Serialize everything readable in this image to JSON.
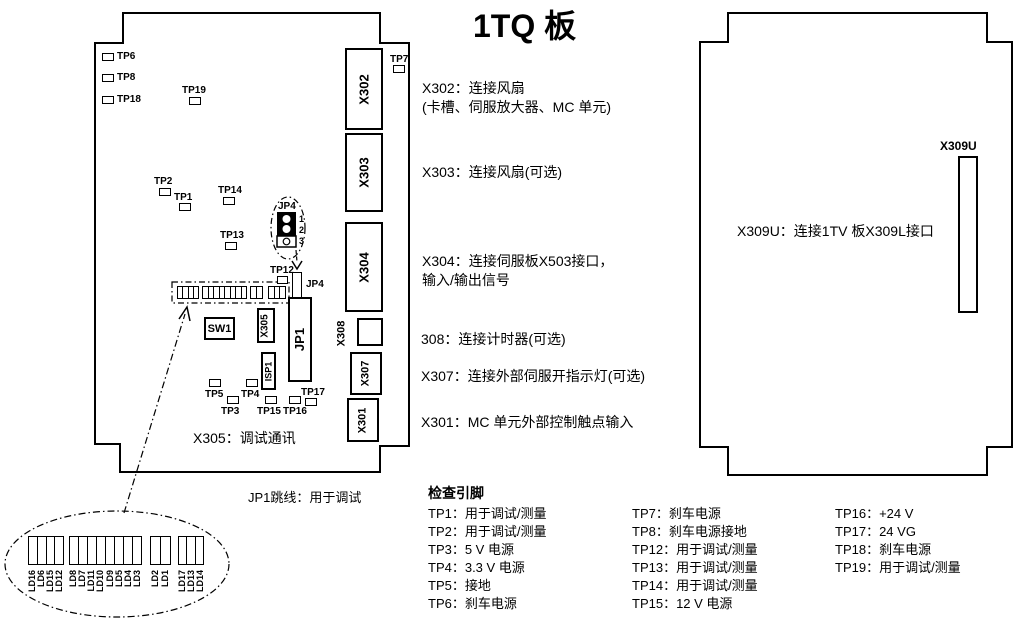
{
  "title": "1TQ 板",
  "colors": {
    "line": "#000000",
    "background": "#ffffff"
  },
  "left_board": {
    "tp_labels": {
      "tp1": "TP1",
      "tp2": "TP2",
      "tp3": "TP3",
      "tp4": "TP4",
      "tp5": "TP5",
      "tp6": "TP6",
      "tp7": "TP7",
      "tp8": "TP8",
      "tp12": "TP12",
      "tp13": "TP13",
      "tp14": "TP14",
      "tp15": "TP15",
      "tp16": "TP16",
      "tp17": "TP17",
      "tp18": "TP18",
      "tp19": "TP19"
    },
    "components": {
      "x302": "X302",
      "x303": "X303",
      "x304": "X304",
      "x308": "X308",
      "x307": "X307",
      "x301": "X301",
      "x305": "X305",
      "jp1": "JP1",
      "isp1": "ISP1",
      "sw1": "SW1",
      "jp4": "JP4"
    },
    "jp4_callout": {
      "title": "JP4",
      "pin1": "1",
      "pin2": "2",
      "pin3": "3"
    },
    "x305_note": "X305：调试通讯"
  },
  "annotations": {
    "x302_line1": "X302：连接风扇",
    "x302_line2": "(卡槽、伺服放大器、MC 单元)",
    "x303": "X303：连接风扇(可选)",
    "x304_line1": "X304：连接伺服板X503接口，",
    "x304_line2": "输入/输出信号",
    "x308": "308：连接计时器(可选)",
    "x307": "X307：连接外部伺服开指示灯(可选)",
    "x301": "X301：MC 单元外部控制触点输入",
    "jp1_note": "JP1跳线：用于调试"
  },
  "right_board": {
    "connector_label": "X309U",
    "note": "X309U：连接1TV 板X309L接口"
  },
  "check_pins": {
    "heading": "检查引脚",
    "col1": [
      "TP1：用于调试/测量",
      "TP2：用于调试/测量",
      "TP3：5 V 电源",
      "TP4：3.3 V 电源",
      "TP5：接地",
      "TP6：刹车电源"
    ],
    "col2": [
      "TP7：刹车电源",
      "TP8：刹车电源接地",
      "TP12：用于调试/测量",
      "TP13：用于调试/测量",
      "TP14：用于调试/测量",
      "TP15：12 V 电源"
    ],
    "col3": [
      "TP16：+24 V",
      "TP17：24 VG",
      "TP18：刹车电源",
      "TP19：用于调试/测量"
    ]
  },
  "led_callout": {
    "group1": [
      "LD16",
      "LD6",
      "LD15",
      "LD12"
    ],
    "group2": [
      "LD8",
      "LD7",
      "LD11",
      "LD10",
      "LD9",
      "LD5",
      "LD4",
      "LD3"
    ],
    "group3": [
      "LD2",
      "LD1"
    ],
    "group4": [
      "LD17",
      "LD13",
      "LD14"
    ]
  }
}
